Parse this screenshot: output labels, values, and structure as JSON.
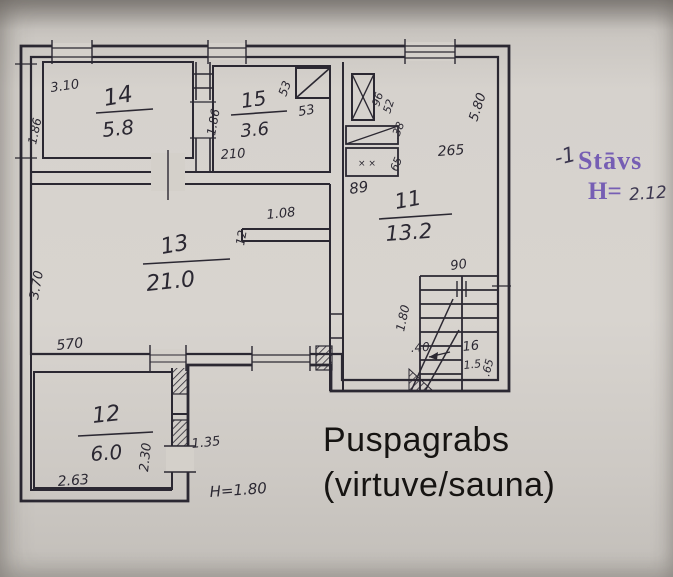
{
  "floorplan": {
    "caption": {
      "line1": "Puspagrabs",
      "line2": "(virtuve/sauna)"
    },
    "stamp": {
      "prefix": "-1",
      "floor_word": "Stāvs",
      "height_label": "H=",
      "height_value": "2.12"
    },
    "rooms": [
      {
        "number": "14",
        "area_m2": "5.8"
      },
      {
        "number": "15",
        "area_m2": "3.6"
      },
      {
        "number": "11",
        "area_m2": "13.2"
      },
      {
        "number": "13",
        "area_m2": "21.0"
      },
      {
        "number": "12",
        "area_m2": "6.0"
      }
    ],
    "colors": {
      "ink": "#2b2832",
      "paper": "#d4d0ca",
      "stamp": "#6e55b2",
      "caption": "#161412"
    },
    "labels": [
      {
        "t": "3.10",
        "x": 51,
        "y": 92,
        "s": 13,
        "r": -8
      },
      {
        "t": "14",
        "x": 105,
        "y": 106,
        "s": 23,
        "r": -10,
        "i": 1
      },
      {
        "t": "5.8",
        "x": 103,
        "y": 137,
        "s": 20,
        "r": -6,
        "i": 1
      },
      {
        "t": "1.86",
        "x": 36,
        "y": 145,
        "s": 12,
        "r": -78
      },
      {
        "t": "15",
        "x": 242,
        "y": 108,
        "s": 20,
        "r": -8,
        "i": 1
      },
      {
        "t": "3.6",
        "x": 241,
        "y": 137,
        "s": 18,
        "r": -5,
        "i": 1
      },
      {
        "t": "1.86",
        "x": 215,
        "y": 136,
        "s": 12,
        "r": -80
      },
      {
        "t": "210",
        "x": 221,
        "y": 159,
        "s": 13,
        "r": -4
      },
      {
        "t": "53",
        "x": 286,
        "y": 97,
        "s": 12,
        "r": -70
      },
      {
        "t": "53",
        "x": 299,
        "y": 116,
        "s": 13,
        "r": -10
      },
      {
        "t": "96",
        "x": 379,
        "y": 107,
        "s": 11,
        "r": -72
      },
      {
        "t": "52",
        "x": 390,
        "y": 114,
        "s": 11,
        "r": -72
      },
      {
        "t": ".38",
        "x": 398,
        "y": 140,
        "s": 11,
        "r": -68
      },
      {
        "t": "65",
        "x": 397,
        "y": 172,
        "s": 11,
        "r": -68
      },
      {
        "t": "× ×",
        "x": 358,
        "y": 166,
        "s": 9,
        "r": 0
      },
      {
        "t": "89",
        "x": 350,
        "y": 194,
        "s": 15,
        "r": -8
      },
      {
        "t": "265",
        "x": 438,
        "y": 156,
        "s": 14,
        "r": -4
      },
      {
        "t": "5.80",
        "x": 477,
        "y": 122,
        "s": 13,
        "r": -72
      },
      {
        "t": "11",
        "x": 396,
        "y": 209,
        "s": 21,
        "r": -10,
        "i": 1
      },
      {
        "t": "13.2",
        "x": 386,
        "y": 241,
        "s": 21,
        "r": -4,
        "i": 1
      },
      {
        "t": "1.08",
        "x": 267,
        "y": 219,
        "s": 13,
        "r": -6
      },
      {
        "t": "12",
        "x": 244,
        "y": 246,
        "s": 12,
        "r": -80
      },
      {
        "t": "13",
        "x": 162,
        "y": 254,
        "s": 22,
        "r": -10,
        "i": 1
      },
      {
        "t": "21.0",
        "x": 147,
        "y": 291,
        "s": 22,
        "r": -6,
        "i": 1
      },
      {
        "t": "3.70",
        "x": 38,
        "y": 300,
        "s": 13,
        "r": -80
      },
      {
        "t": "570",
        "x": 57,
        "y": 350,
        "s": 14,
        "r": -6
      },
      {
        "t": "90",
        "x": 451,
        "y": 270,
        "s": 13,
        "r": -8
      },
      {
        "t": "1.80",
        "x": 404,
        "y": 332,
        "s": 12,
        "r": -78
      },
      {
        "t": ".40",
        "x": 411,
        "y": 352,
        "s": 12,
        "r": -4
      },
      {
        "t": "16",
        "x": 463,
        "y": 351,
        "s": 13,
        "r": -6
      },
      {
        "t": "1.5",
        "x": 464,
        "y": 369,
        "s": 11,
        "r": -6
      },
      {
        "t": ".65",
        "x": 489,
        "y": 377,
        "s": 11,
        "r": -75
      },
      {
        "t": "12",
        "x": 93,
        "y": 423,
        "s": 22,
        "r": -6,
        "i": 1
      },
      {
        "t": "6.0",
        "x": 91,
        "y": 461,
        "s": 20,
        "r": -4,
        "i": 1
      },
      {
        "t": "2.63",
        "x": 58,
        "y": 486,
        "s": 14,
        "r": -4
      },
      {
        "t": "2.30",
        "x": 148,
        "y": 472,
        "s": 13,
        "r": -84
      },
      {
        "t": "1.35",
        "x": 192,
        "y": 448,
        "s": 13,
        "r": -6
      },
      {
        "t": "H=1.80",
        "x": 210,
        "y": 497,
        "s": 15,
        "r": -4
      }
    ],
    "bars": [
      {
        "x1": 96,
        "y1": 113,
        "x2": 153,
        "y2": 109
      },
      {
        "x1": 231,
        "y1": 115,
        "x2": 287,
        "y2": 111
      },
      {
        "x1": 143,
        "y1": 264,
        "x2": 230,
        "y2": 259
      },
      {
        "x1": 379,
        "y1": 219,
        "x2": 452,
        "y2": 214
      },
      {
        "x1": 78,
        "y1": 436,
        "x2": 153,
        "y2": 432
      }
    ]
  }
}
